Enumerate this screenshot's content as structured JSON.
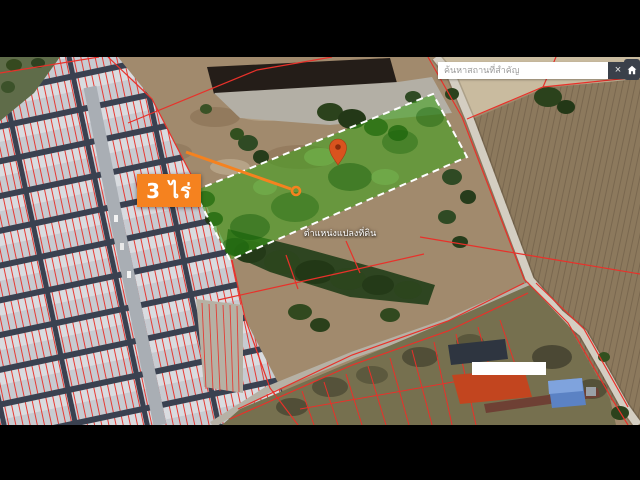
{
  "search": {
    "placeholder": "ค้นหาสถานที่สำคัญ",
    "close_label": "×"
  },
  "map_overlay": {
    "area_label": "3 ไร่",
    "pin_caption": "ตำแหน่งแปลงที่ดิน"
  },
  "icons": [
    "close-icon",
    "home-icon",
    "location-pin-icon"
  ],
  "colors": {
    "accent_orange": "#F5821F",
    "pin_orange": "#D9531E",
    "plot_green": "#3BA318",
    "plot_border_white": "#FFFFFF",
    "cadastral_red": "#E8312A",
    "search_button_dark": "#3A404A",
    "letterbox_black": "#000000"
  }
}
